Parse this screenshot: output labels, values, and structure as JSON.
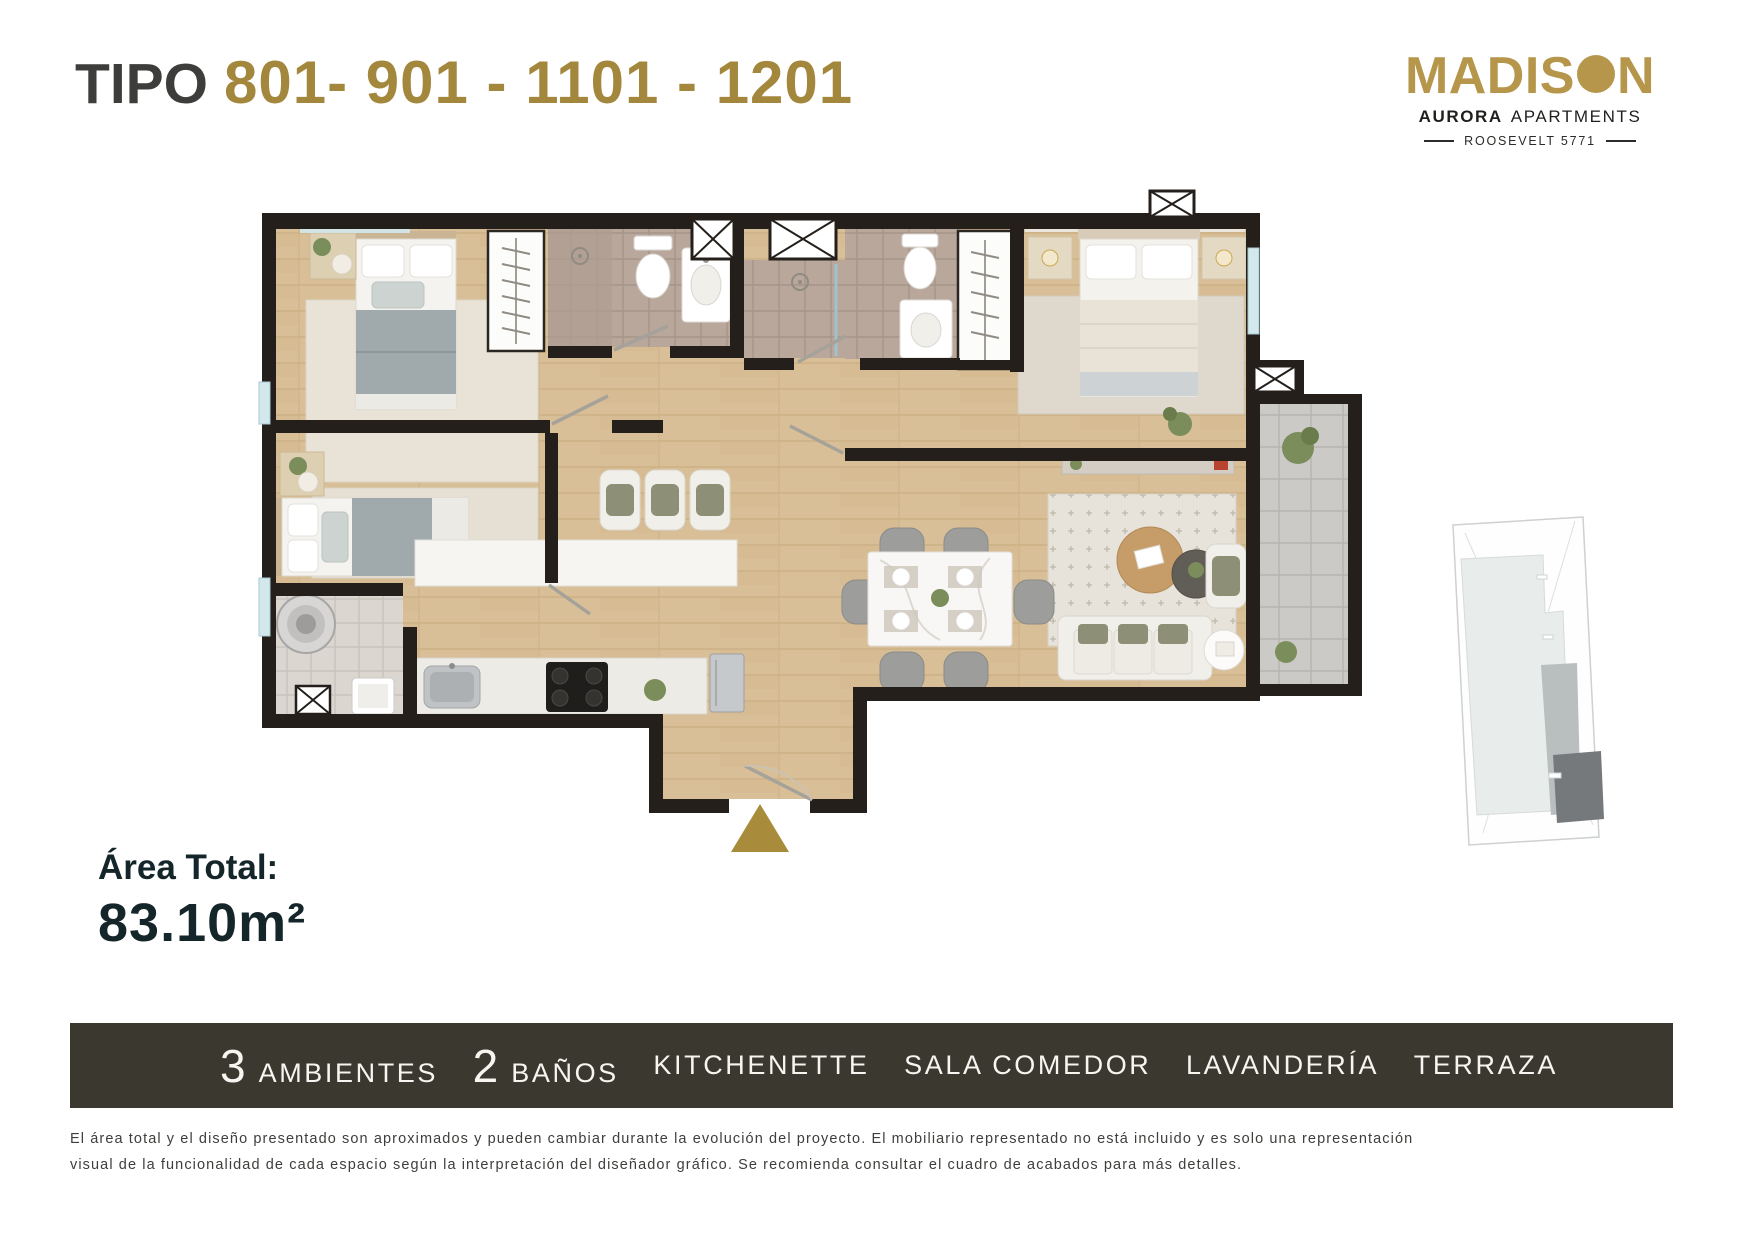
{
  "title": {
    "prefix": "TIPO",
    "numbers": "801- 901 - 1101 - 1201"
  },
  "logo": {
    "name_part1": "MADIS",
    "name_part2": "N",
    "tagline_bold": "AURORA",
    "tagline_rest": "APARTMENTS",
    "address": "ROOSEVELT 5771"
  },
  "area": {
    "label": "Área Total:",
    "value": "83.10m²"
  },
  "features": [
    {
      "number": "3",
      "label": "AMBIENTES"
    },
    {
      "number": "2",
      "label": "BAÑOS"
    },
    {
      "number": "",
      "label": "KITCHENETTE"
    },
    {
      "number": "",
      "label": "SALA COMEDOR"
    },
    {
      "number": "",
      "label": "LAVANDERÍA"
    },
    {
      "number": "",
      "label": "TERRAZA"
    }
  ],
  "disclaimer": {
    "line1": "El área total y el diseño presentado son aproximados y pueden cambiar durante la evolución del proyecto. El mobiliario representado no está incluido y es solo una representación",
    "line2": "visual de la funcionalidad de cada espacio según la interpretación del diseñador gráfico. Se recomienda consultar el cuadro de acabados para más detalles."
  },
  "colors": {
    "title_gold": "#a3873c",
    "logo_gold": "#b5964a",
    "entry_arrow_gold": "#a88c3c",
    "bar_background": "#3a382f",
    "ink_dark": "#15262b",
    "wall_black": "#241f1a",
    "wood_floor": "#d8bf97"
  }
}
